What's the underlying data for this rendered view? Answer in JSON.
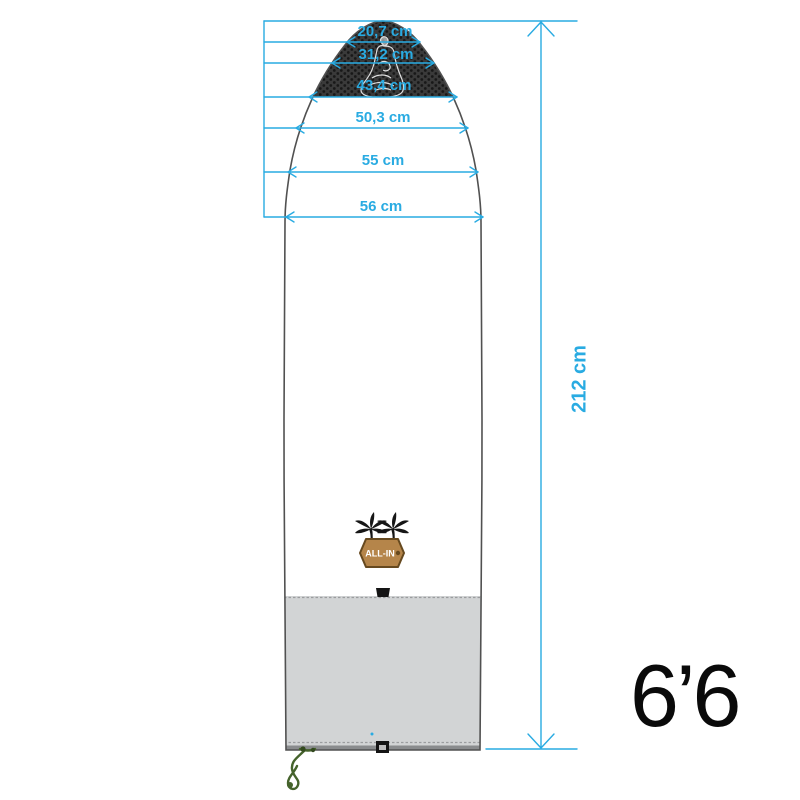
{
  "diagram": {
    "accent_color": "#29abe2",
    "size_label": "6’6",
    "length_label": "212 cm",
    "length_cm": 212,
    "width_labels": [
      "20,7 cm",
      "31,2 cm",
      "43,4 cm",
      "50,3 cm",
      "55 cm",
      "56 cm"
    ],
    "width_values_cm": [
      20.7,
      31.2,
      43.4,
      50.3,
      55,
      56
    ],
    "badge_text": "ALL-IN",
    "colors": {
      "nose_panel": "#373737",
      "body_panel": "#ffffff",
      "tail_panel": "#d2d4d5",
      "outline": "#515151",
      "dimension_lines": "#29abe2",
      "cord": "#45632c",
      "badge": "#b5854a"
    }
  }
}
